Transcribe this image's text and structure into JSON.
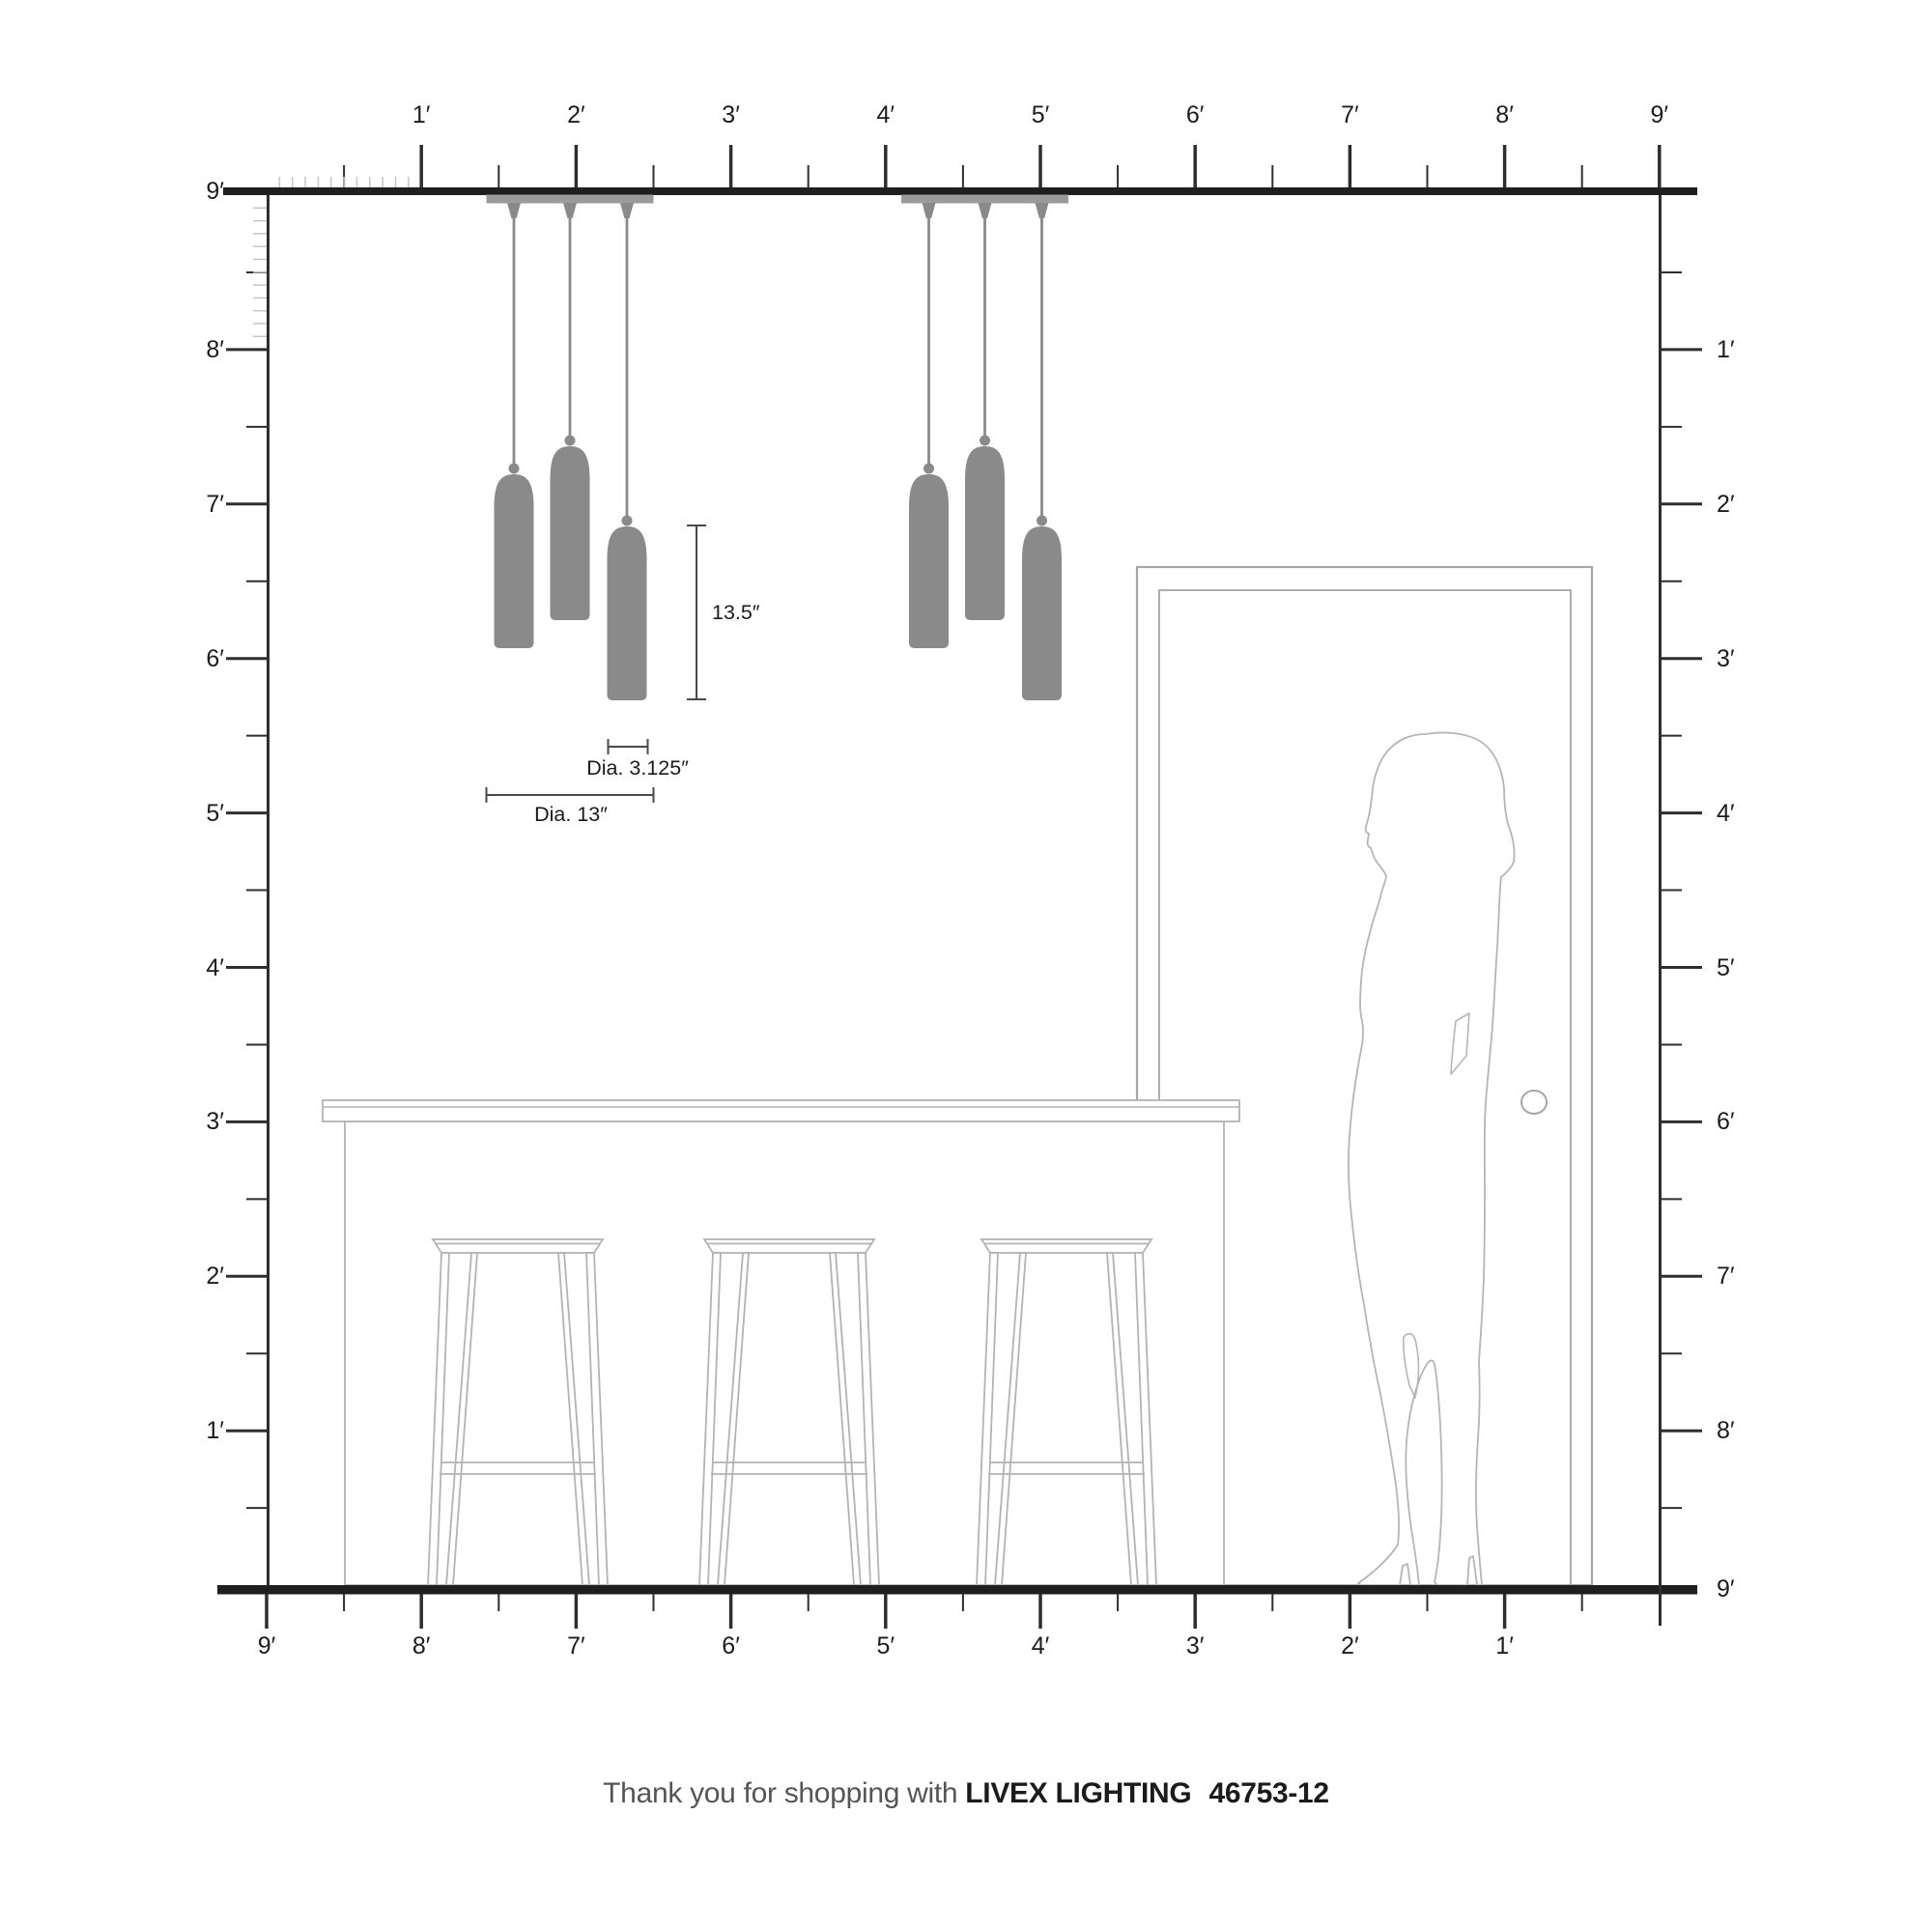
{
  "title": "Livex Lighting pendant scale diagram",
  "rulers": {
    "top": {
      "labels": [
        "1′",
        "2′",
        "3′",
        "4′",
        "5′",
        "6′",
        "7′",
        "8′",
        "9′"
      ]
    },
    "left": {
      "labels": [
        "9′",
        "8′",
        "7′",
        "6′",
        "5′",
        "4′",
        "3′",
        "2′",
        "1′"
      ]
    },
    "right": {
      "labels": [
        "1′",
        "2′",
        "3′",
        "4′",
        "5′",
        "6′",
        "7′",
        "8′",
        "9′"
      ]
    },
    "bottom": {
      "labels": [
        "9′",
        "8′",
        "7′",
        "6′",
        "5′",
        "4′",
        "3′",
        "2′",
        "1′"
      ]
    }
  },
  "dimensions": {
    "pendant_height": "13.5″",
    "shade_diameter": "Dia. 3.125″",
    "canopy_diameter": "Dia. 13″"
  },
  "fixture": {
    "canopy_count": 2,
    "pendants_per_canopy": 3
  },
  "footer": {
    "prefix": "Thank you for shopping with",
    "brand": "LIVEX LIGHTING",
    "model": "46753-12"
  },
  "colors": {
    "pendant_gray": "#8a8a8a",
    "canopy_gray": "#9b9b9b",
    "structure_dark": "#1f1f1f",
    "tick_dark": "#2e2e2e",
    "inch_tick_light": "#c6c6c6",
    "furniture_outline": "#b3b3b3",
    "door_outline": "#a5a5a5",
    "silhouette_outline": "#b5b5b5",
    "dimension_line": "#4a4a4a"
  }
}
